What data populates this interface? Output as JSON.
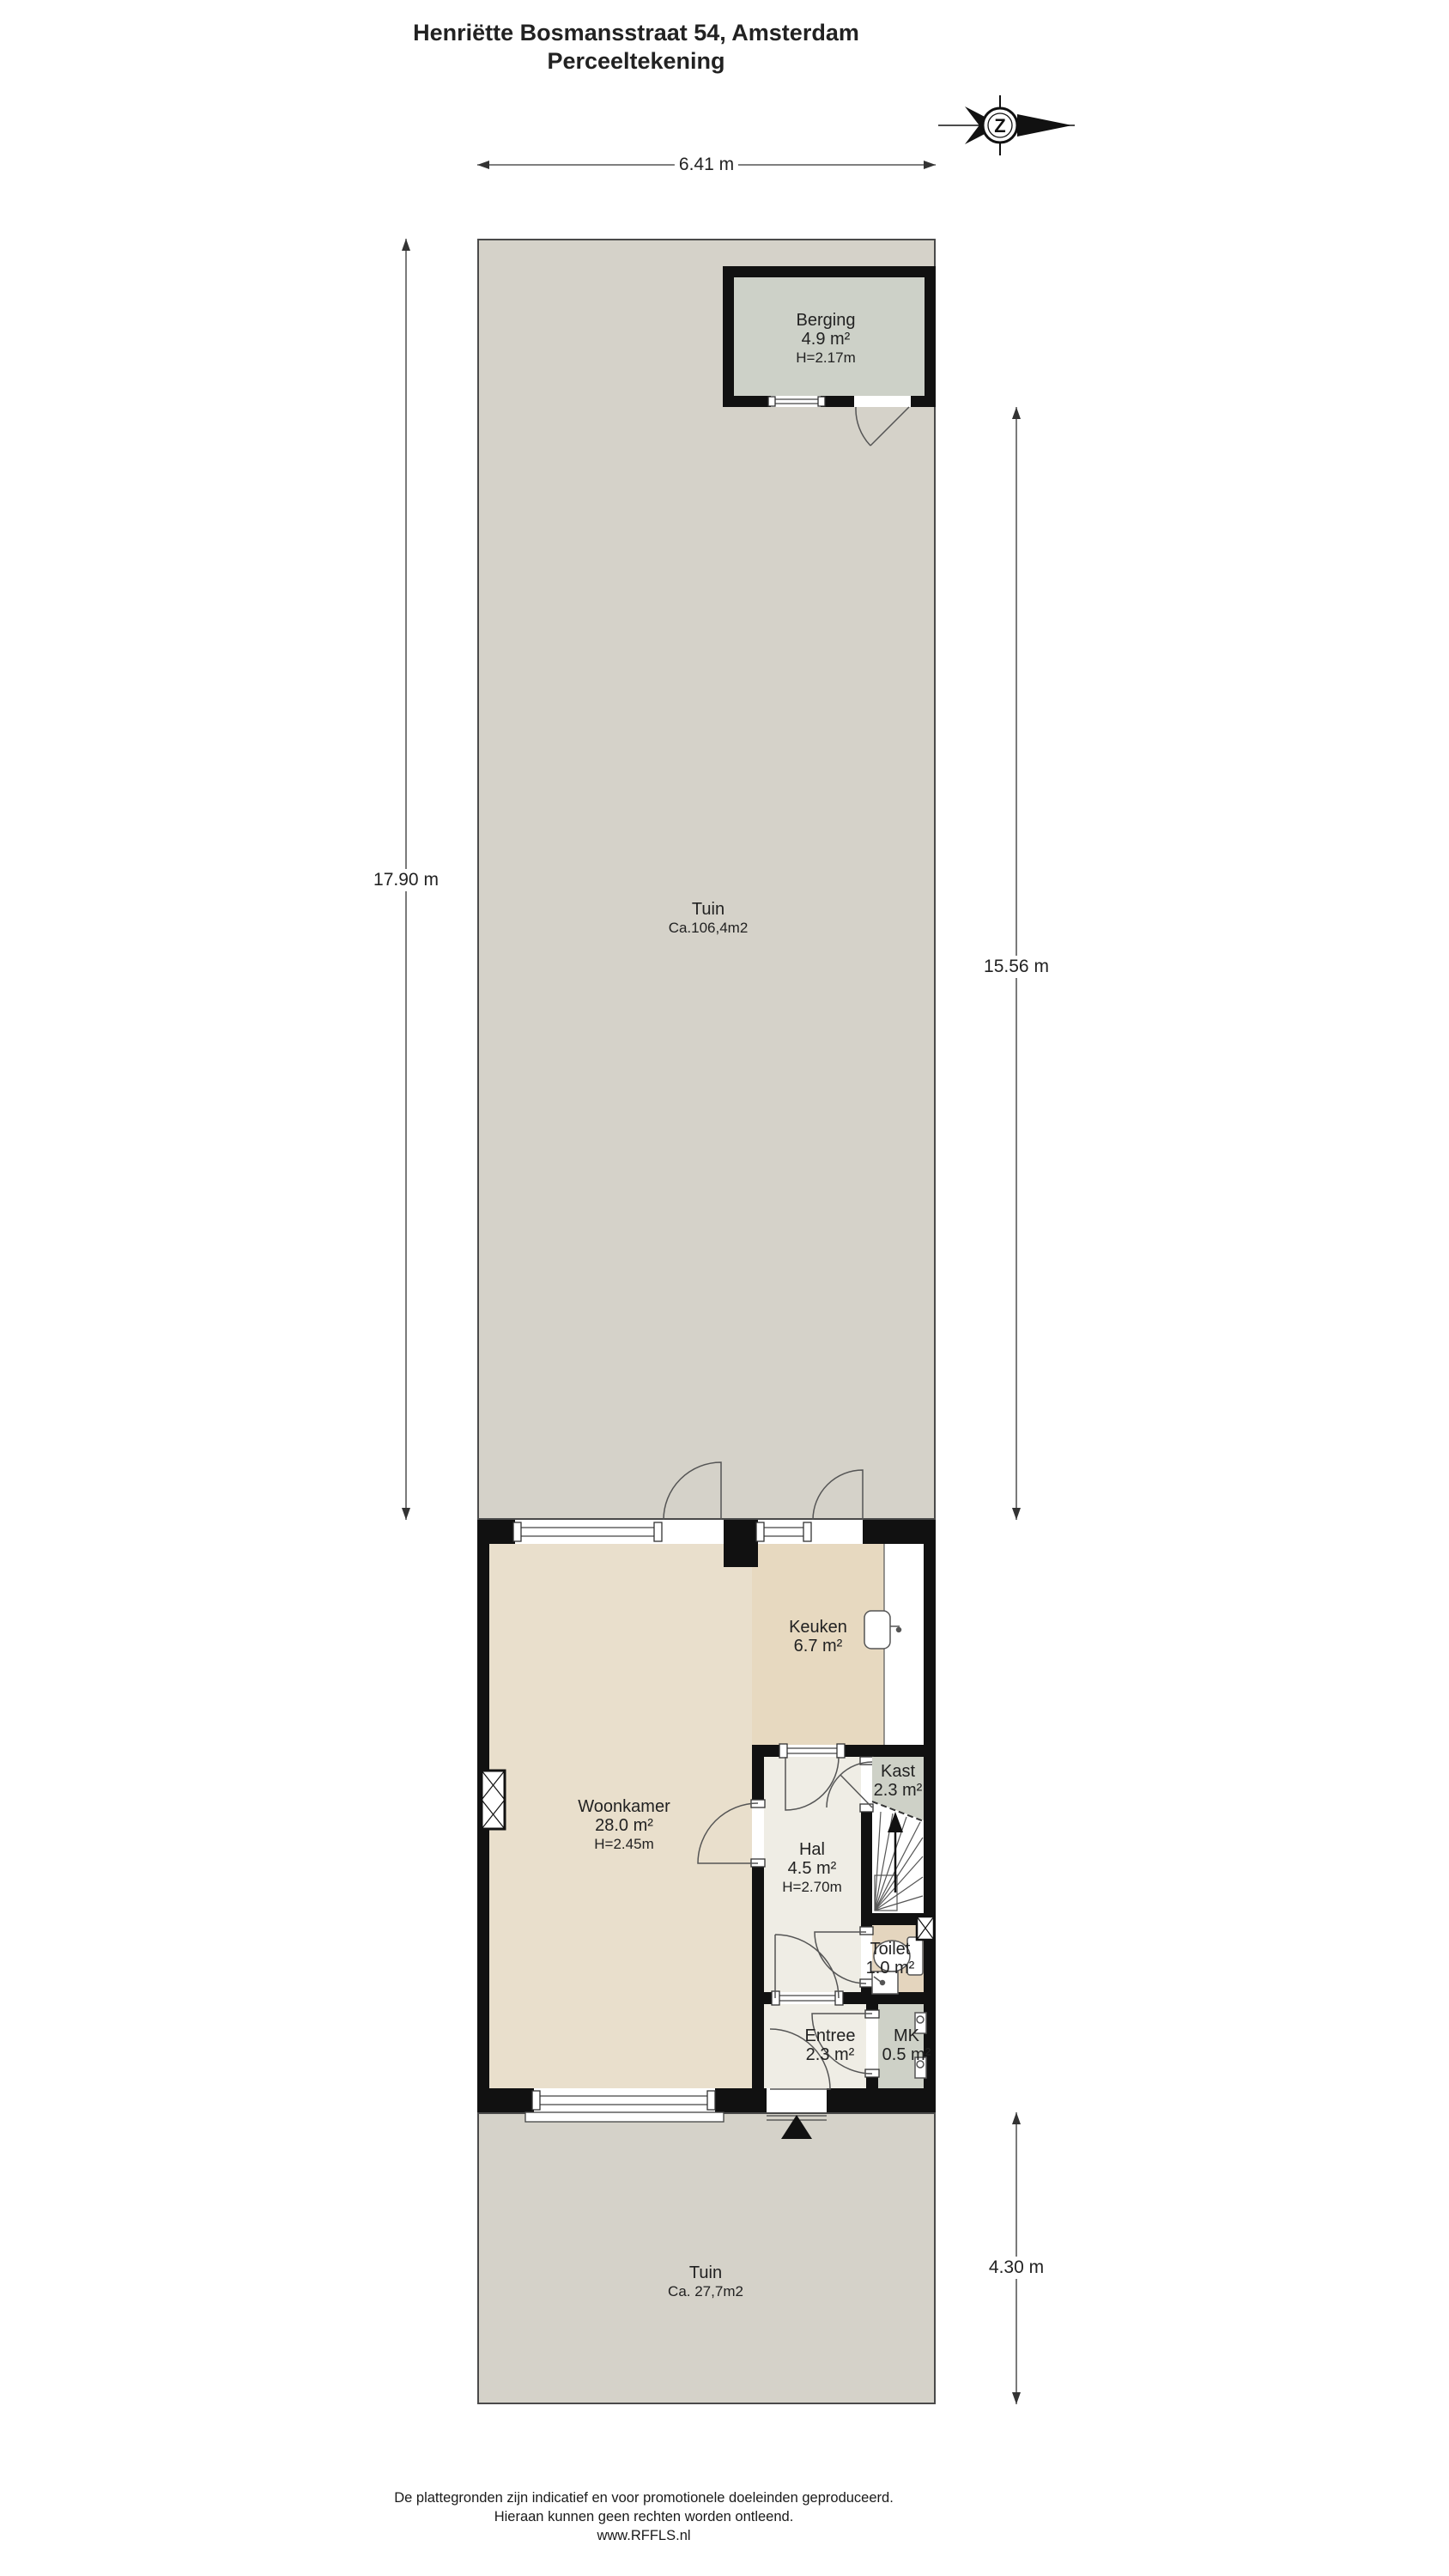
{
  "title": {
    "line1": "Henriëtte Bosmansstraat 54, Amsterdam",
    "line2": "Perceeltekening"
  },
  "compass": {
    "letter": "Z"
  },
  "dimensions": {
    "top": "6.41 m",
    "left": "17.90 m",
    "right_back": "15.56 m",
    "right_front": "4.30 m"
  },
  "rooms": {
    "tuin_back": {
      "name": "Tuin",
      "area": "Ca.106,4m2"
    },
    "berging": {
      "name": "Berging",
      "area": "4.9 m²",
      "height": "H=2.17m"
    },
    "woonkamer": {
      "name": "Woonkamer",
      "area": "28.0 m²",
      "height": "H=2.45m"
    },
    "keuken": {
      "name": "Keuken",
      "area": "6.7 m²"
    },
    "kast": {
      "name": "Kast",
      "area": "2.3 m²"
    },
    "hal": {
      "name": "Hal",
      "area": "4.5 m²",
      "height": "H=2.70m"
    },
    "toilet": {
      "name": "Toilet",
      "area": "1.0 m²"
    },
    "entree": {
      "name": "Entree",
      "area": "2.3 m²"
    },
    "mk": {
      "name": "MK",
      "area": "0.5 m²"
    },
    "tuin_front": {
      "name": "Tuin",
      "area": "Ca. 27,7m2"
    }
  },
  "footer": {
    "line1": "De plattegronden zijn indicatief en voor promotionele doeleinden geproduceerd.",
    "line2": "Hieraan kunnen geen rechten worden ontleend.",
    "line3": "www.RFFLS.nl"
  },
  "colors": {
    "garden": "#d5d2c9",
    "berging_floor": "#cdd1c8",
    "woonkamer_floor": "#e9dfcc",
    "keuken_floor": "#e7d9c0",
    "hal_floor": "#efede5",
    "toilet_floor": "#e4d5be",
    "closet_floor": "#ced1c7",
    "wall": "#111111",
    "line": "#555555"
  }
}
